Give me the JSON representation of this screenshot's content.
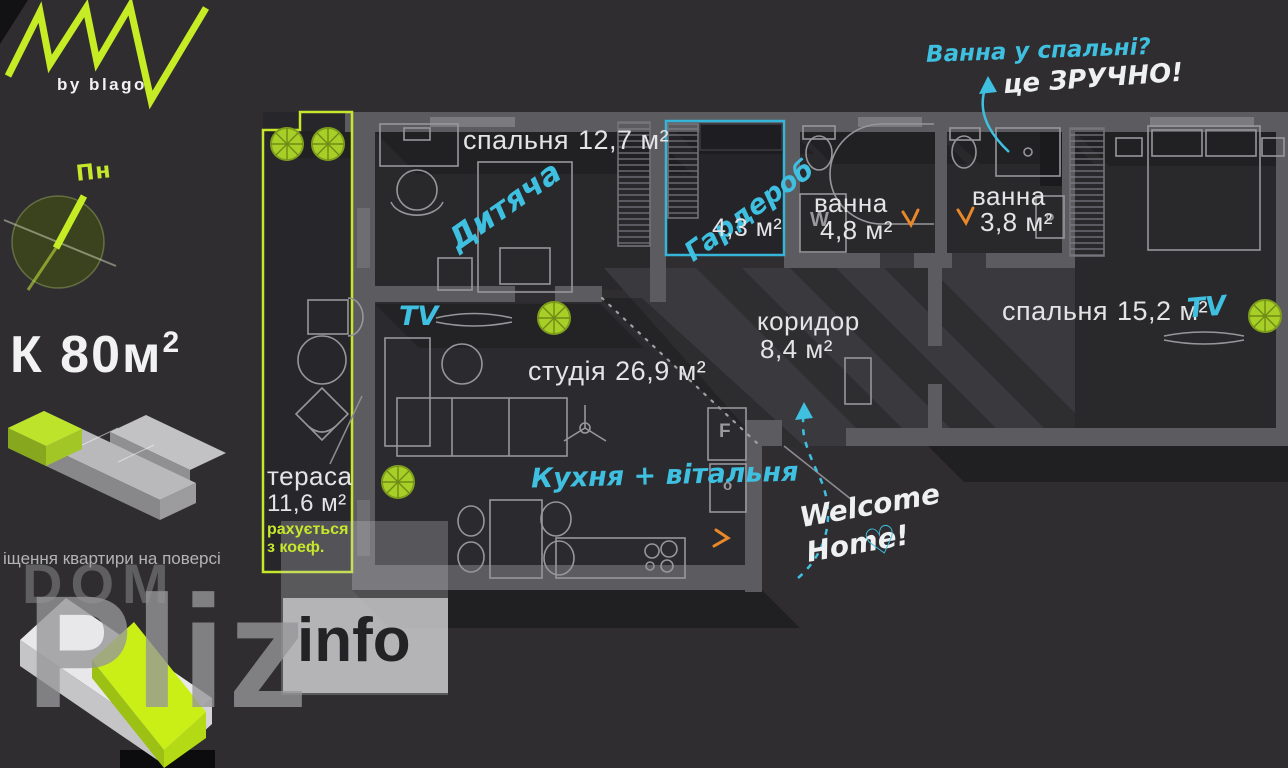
{
  "colors": {
    "accent_lime": "#c6e82c",
    "accent_cyan": "#3fc0e0",
    "accent_orange": "#e8882a"
  },
  "branding": {
    "tagline": "by blago",
    "compass_north": "Пн",
    "area_code": "К 80м",
    "area_sup": "2",
    "floor_note": "іщення квартири на поверсі"
  },
  "watermark": {
    "word1": "DOM",
    "word2": "Pliz",
    "word3": "info"
  },
  "annotations": {
    "bath_question": "Ванна у спальні?",
    "bath_answer": "це ЗРУЧНО!",
    "welcome_line1": "Welcome",
    "welcome_line2": "Home!",
    "heart": "♡"
  },
  "markers": {
    "tv": "TV",
    "fridge": "F",
    "oven": "o",
    "washer": "W"
  },
  "rooms": [
    {
      "name": "спальня",
      "area": "12,7 м²",
      "note": "Дитяча"
    },
    {
      "name": "Гардероб",
      "area": "4,3 м²"
    },
    {
      "name": "ванна",
      "area": "4,8 м²"
    },
    {
      "name": "ванна",
      "area": "3,8 м²"
    },
    {
      "name": "спальня",
      "area": "15,2 м²"
    },
    {
      "name": "коридор",
      "area": "8,4 м²"
    },
    {
      "name": "студія",
      "area": "26,9 м²",
      "note": "Кухня + вітальня"
    },
    {
      "name": "тераса",
      "area": "11,6 м²",
      "note_line1": "рахується",
      "note_line2": "з коеф."
    }
  ]
}
